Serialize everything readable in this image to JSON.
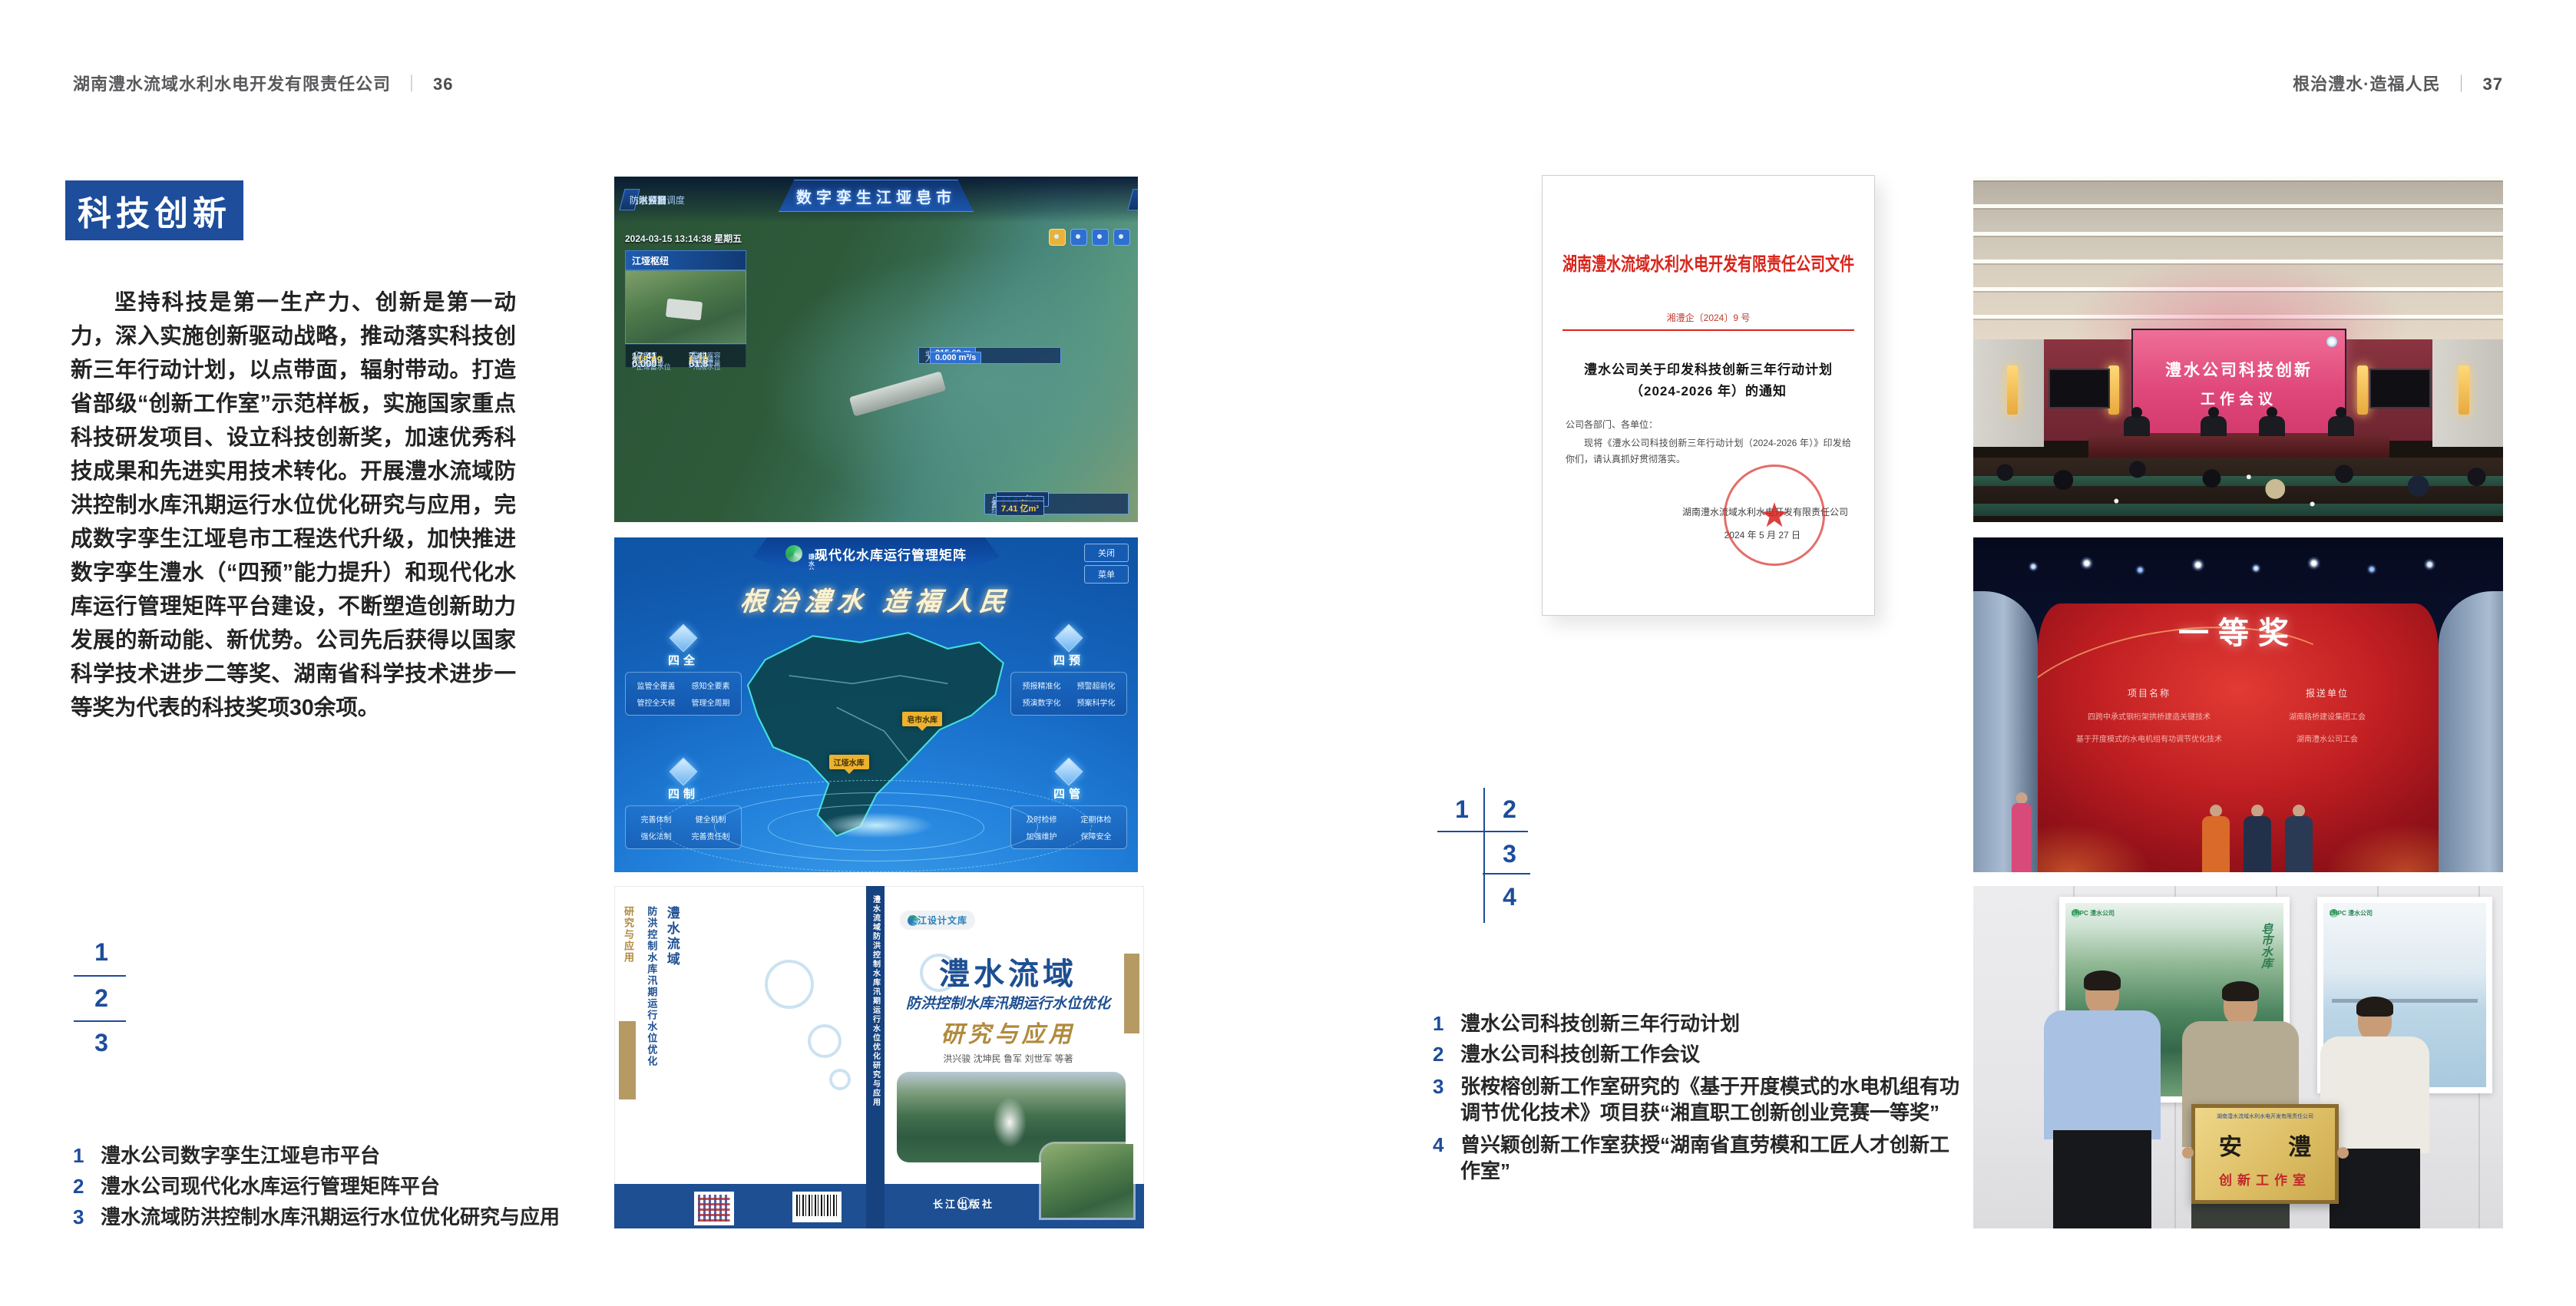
{
  "page_left": {
    "header": {
      "company": "湖南澧水流域水利水电开发有限责任公司",
      "divider": "｜",
      "page_no": "36"
    },
    "section_title": "科技创新",
    "paragraph": "坚持科技是第一生产力、创新是第一动力，深入实施创新驱动战略，推动落实科技创新三年行动计划，以点带面，辐射带动。打造省部级“创新工作室”示范样板，实施国家重点科技研发项目、设立科技创新奖，加速优秀科技成果和先进实用技术转化。开展澧水流域防洪控制水库汛期运行水位优化研究与应用，完成数字孪生江垭皂市工程迭代升级，加快推进数字孪生澧水（“四预”能力提升）和现代化水库运行管理矩阵平台建设，不断塑造创新助力发展的新动能、新优势。公司先后获得以国家科学技术进步二等奖、湖南省科学技术进步一等奖为代表的科技奖项30余项。",
    "figure_index": [
      "1",
      "2",
      "3"
    ],
    "captions": [
      {
        "num": "1",
        "text": "澧水公司数字孪生江垭皂市平台"
      },
      {
        "num": "2",
        "text": "澧水公司现代化水库运行管理矩阵平台"
      },
      {
        "num": "3",
        "text": "澧水流域防洪控制水库汛期运行水位优化研究与应用"
      }
    ],
    "dashboard": {
      "title": "数字孪生江垭皂市",
      "nav_group_label": "防洪兴利调度",
      "nav_left": [
        "实时监测",
        "洪水预报",
        "防洪预警"
      ],
      "nav_right": [
        "会商预演",
        "预案生成",
        "调度执行",
        "工程导览"
      ],
      "timestamp": "2024-03-15 13:14:38 星期五",
      "panel_title": "江垭枢纽",
      "stats": [
        {
          "label": "总库容",
          "value": "17.41",
          "unit": "亿m³"
        },
        {
          "label": "拦洪库容",
          "value": "7.41",
          "unit": "亿m³"
        },
        {
          "label": "坝上水位",
          "value": "215.69",
          "unit": "m"
        },
        {
          "label": "蓄水量",
          "value": "8.10",
          "unit": "亿m³"
        },
        {
          "label": "入库流量",
          "value": "0.000",
          "unit": "m³/s"
        },
        {
          "label": "出库流量",
          "value": "61.8",
          "unit": "m³/s"
        },
        {
          "label": "正常蓄水位",
          "value": "",
          "unit": ""
        },
        {
          "label": "汛限水位",
          "value": "",
          "unit": ""
        }
      ],
      "tooltip": {
        "rows": [
          {
            "label": "坝上水位",
            "value": "215.69 m"
          },
          {
            "label": "入库流量",
            "value": "0.000 m³/s"
          }
        ]
      },
      "side_panel": {
        "rows": [
          {
            "label": "总库容",
            "value": "17.41 亿m³"
          },
          {
            "label": "蓄水量",
            "value": "8.10 亿m³"
          },
          {
            "label": "拦洪库容",
            "value": "7.41 亿m³"
          }
        ]
      }
    },
    "platform": {
      "logo_text": "LHPC",
      "brand": "澧水公司",
      "title": "现代化水库运行管理矩阵",
      "slogan": "根治澧水 造福人民",
      "btn_close": "关闭",
      "btn_menu": "菜单",
      "groups": [
        {
          "name": "四全",
          "items": [
            "监管全覆盖",
            "感知全要素",
            "管控全天候",
            "管理全周期"
          ]
        },
        {
          "name": "四预",
          "items": [
            "预报精准化",
            "预警超前化",
            "预演数字化",
            "预案科学化"
          ]
        },
        {
          "name": "四制",
          "items": [
            "完善体制",
            "健全机制",
            "强化法制",
            "完善责任制"
          ]
        },
        {
          "name": "四管",
          "items": [
            "及时检修",
            "定期体检",
            "加强维护",
            "保障安全"
          ]
        }
      ],
      "markers": [
        "江垭水库",
        "皂市水库"
      ]
    },
    "book": {
      "brand": "长江设计文库",
      "title_main": "澧水流域",
      "title_sub": "防洪控制水库汛期运行水位优化",
      "title_tail": "研究与应用",
      "authors": "洪兴骏 沈坤民 鲁军 刘世军 等著",
      "spine": "澧水流域防洪控制水库汛期运行水位优化研究与应用",
      "publisher": "长江出版社"
    }
  },
  "page_right": {
    "header": {
      "title": "根治澧水·造福人民",
      "divider": "｜",
      "page_no": "37"
    },
    "document": {
      "header": "湖南澧水流域水利水电开发有限责任公司文件",
      "doc_no": "湘澧企〔2024〕9 号",
      "title_line1": "澧水公司关于印发科技创新三年行动计划",
      "title_line2": "（2024-2026 年）的通知",
      "salutation": "公司各部门、各单位：",
      "body": "现将《澧水公司科技创新三年行动计划（2024-2026 年）》印发给你们，请认真抓好贯彻落实。",
      "signer": "湖南澧水流域水利水电开发有限责任公司",
      "date": "2024 年 5 月 27 日"
    },
    "figure_index": [
      "1",
      "2",
      "3",
      "4"
    ],
    "captions": [
      {
        "num": "1",
        "text": "澧水公司科技创新三年行动计划"
      },
      {
        "num": "2",
        "text": "澧水公司科技创新工作会议"
      },
      {
        "num": "3",
        "text": "张桉榕创新工作室研究的《基于开度模式的水电机组有功调节优化技术》项目获“湘直职工创新创业竞赛一等奖”"
      },
      {
        "num": "4",
        "text": "曾兴颖创新工作室获授“湖南省直劳模和工匠人才创新工作室”"
      }
    ],
    "meeting": {
      "screen_line1": "澧水公司科技创新",
      "screen_line2": "工作会议"
    },
    "award": {
      "title": "一等奖",
      "col_project": "项目名称",
      "col_unit": "报送单位",
      "projects": [
        "四跨中承式钢桁架拱桥建造关键技术",
        "基于开度模式的水电机组有功调节优化技术"
      ],
      "units": [
        "湖南路桥建设集团工会",
        "湖南澧水公司工会"
      ]
    },
    "plaque": {
      "org": "湖南澧水流域水利水电开发有限责任公司",
      "main": "安 澧",
      "sub": "创新工作室",
      "poster_logo": "LHPC 澧水公司",
      "poster_left_caption": "皂市水库"
    }
  }
}
